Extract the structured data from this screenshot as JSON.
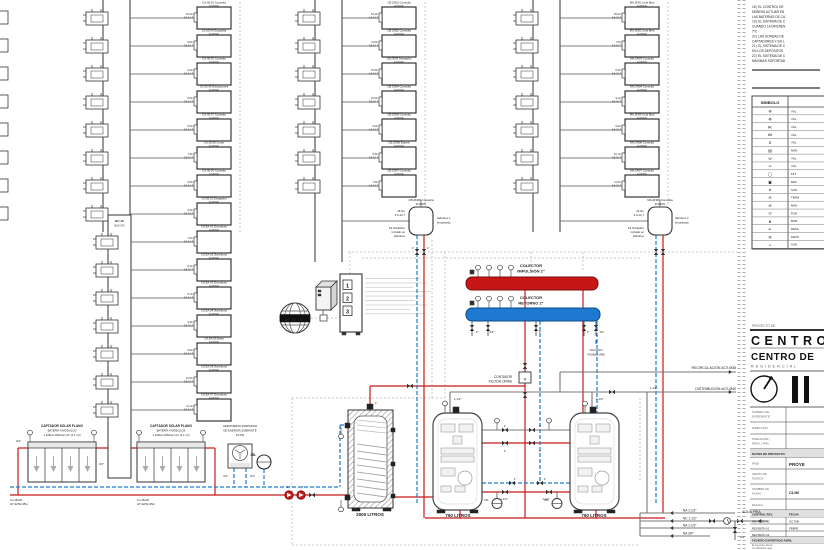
{
  "meta": {
    "red": "#c81a1a",
    "blue": "#1e7ad0",
    "gray": "#8a8a8a",
    "wire": "#c9c9c9",
    "dark": "#333333"
  },
  "notes": {
    "lines": [
      "18 | EL CONTROL DE",
      "DEBERÁ ACTUAR EN",
      "LAS BATERÍAS DE CA",
      "19 | EL SISTEMA DE C",
      "CUANDO LA DIFEREN",
      "7ºC",
      "20 | LAS SONDAS DE",
      "CAPTADORES Y EN L",
      "21 | EL SISTEMA DE C",
      "EN LOS DEPÓSITOS",
      "22 | EL SISTEMA DE C",
      "MÁXIMAS SOPORTAD"
    ]
  },
  "legend": {
    "title": "SÍMBOLO",
    "rows": [
      {
        "sym": "⊕",
        "label": "VÁL"
      },
      {
        "sym": "⊗",
        "label": "VÁL"
      },
      {
        "sym": "⋉",
        "label": "VÁL"
      },
      {
        "sym": "⋈",
        "label": "VÁL"
      },
      {
        "sym": "Ƨ",
        "label": "VÁL"
      },
      {
        "sym": "▤",
        "label": "MAN"
      },
      {
        "sym": "Ψ",
        "label": "VÁL"
      },
      {
        "sym": "∞",
        "label": "VÁL"
      },
      {
        "sym": "◯",
        "label": "FILT"
      },
      {
        "sym": "▣",
        "label": "DES"
      },
      {
        "sym": "♦",
        "label": "SON"
      },
      {
        "sym": "⊖",
        "label": "TERM"
      },
      {
        "sym": "⊘",
        "label": "MAN"
      },
      {
        "sym": "⊙",
        "label": "PUR"
      },
      {
        "sym": "▲",
        "label": "BOM"
      },
      {
        "sym": "↵",
        "label": "DESA"
      },
      {
        "sym": "⊜",
        "label": "DEPÓ"
      },
      {
        "sym": "⊥",
        "label": "SON"
      }
    ]
  },
  "titleblock": {
    "proyecto_de": "PROYECTO DE:",
    "title1": "CENTRO",
    "title2": "CENTRO DE",
    "title3": "RESIDENCIAL",
    "f1a": "NÚMERO DE",
    "f1b": "EXPEDIENTE",
    "f2": "DIRECCIÓN",
    "f3a": "POBLACIÓN |",
    "f3b": "PROV. | PAÍS",
    "datos": "DATOS DE PROYECTO",
    "fase": "FASE",
    "fase_v": "PROYE",
    "grupo_a": "GRUPO DE",
    "grupo_b": "PLANOS",
    "nombre_a": "NOMBRE DE",
    "nombre_b": "PLANO",
    "nombre_v": "CLIM",
    "escala": "ESCALA",
    "control": "CONTROL REV.",
    "fecha": "FECHA",
    "rev0": "REVISIÓN 00",
    "rev0_v": "OCTUB",
    "rev1": "REVISIÓN 01",
    "rev1_v": "FEBRE",
    "rev2": "REVISIÓN 02",
    "fichero": "FICHERO EXPORTADO ABRIL",
    "disc": [
      "El presente docum",
      "su utilización requ",
      "autorización expre"
    ]
  },
  "collectors": {
    "supply1": "COLECTOR",
    "supply2": "IMPULSIÓN 2\"",
    "return1": "COLECTOR",
    "return2": "RETORNO 2\""
  },
  "center": {
    "www": "WWW",
    "panel": [
      "1",
      "2",
      "3"
    ],
    "contador1": "CONTADOR",
    "contador2": "KILOCALORÍAS",
    "meter": "M",
    "vaciado1": "VACIADO",
    "vaciado2": "VISIBLE Ø40"
  },
  "tanks": {
    "t1": "2000 LITROS",
    "t2": "750 LITROS",
    "t3": "750 LITROS",
    "v1": "12L",
    "v2": "12L"
  },
  "solar": {
    "title": "CAPTADOR SOLAR PLANO",
    "sub": "BATERÍA 4 MÓDULOS",
    "dims": "1.108x2.118x112 mm (2,1 m²)",
    "pipe1": "Cu 28x25",
    "pipe2": "HT-32/52-35H",
    "aero1": "AEROTERMO DISIPADOR",
    "aero2": "DE ENERGÍA SOBRANTE",
    "aero3": "16 KW",
    "vessel": "35L"
  },
  "acs": {
    "recirc": "RECIRCULACIÓN ACS Ø38",
    "distrib": "DISTRIBUCIÓN ACS Ø40"
  },
  "bottom": {
    "na1": "NA 1-1/2\"",
    "nc": "NC 1-1/2\"",
    "na2": "NA 1-1/2\"",
    "na3": "NA 3/4\"",
    "agua": "AGUA FRÍA"
  },
  "sizes": {
    "s34": "3/4\"",
    "s1": "1\"",
    "s112": "1-1/2\"",
    "s2": "2\"",
    "s12": "1/2\""
  },
  "units": {
    "model": "FUZION",
    "g1": {
      "rows": [
        {
          "name": "CA.05.03 Consulta",
          "len": "10,6m",
          "spec": "0,6-10,7"
        },
        {
          "name": "CA.05.04 Ecografía",
          "len": "9,8m",
          "spec": "0,6-10,7"
        },
        {
          "name": "CA.05.05 Consulta",
          "len": "9,2m",
          "spec": "0,6-10,7"
        },
        {
          "name": "CA.05.06 Extracciones",
          "len": "8,6m",
          "spec": "0,6-10,7"
        },
        {
          "name": "CA.05.07 Consulta",
          "len": "8,0m",
          "spec": "0,6-10,7"
        },
        {
          "name": "CA.05.08 Curas",
          "len": "7,4m",
          "spec": "0,6-10,7"
        },
        {
          "name": "CA.05.09 Consulta",
          "len": "6,8m",
          "spec": "0,6-10,7"
        },
        {
          "name": "CA.05.10 Despacho",
          "len": "6,2m",
          "spec": "0,6-10,7"
        }
      ]
    },
    "g2": {
      "rows": [
        {
          "name": "CB.ZN01 Consulta",
          "len": "12,4m",
          "spec": "0,6-10,7"
        },
        {
          "name": "CB.ZN02 Consulta",
          "len": "11,6m",
          "spec": "0,6-10,7"
        },
        {
          "name": "CB.ZN03 Despacho",
          "len": "10,8m",
          "spec": "0,6-10,7"
        },
        {
          "name": "CB.ZN04 Consulta",
          "len": "10,0m",
          "spec": "0,6-10,7"
        },
        {
          "name": "CB.ZN05 Consulta",
          "len": "9,2m",
          "spec": "0,6-10,7"
        },
        {
          "name": "CB.ZN06 Espera",
          "len": "8,4m",
          "spec": "0,6-10,7"
        },
        {
          "name": "CB.ZN07 Consulta",
          "len": "7,6m",
          "spec": "0,6-10,7"
        }
      ],
      "special": {
        "name": "CB.ZN08 Consulta",
        "len": "45,0m",
        "spec": "4,0-12,7",
        "hb1": "Hidrobox 1",
        "hb2": "encastrado",
        "kit1": "Kit hidráulico",
        "kit2": "incluido en",
        "kit3": "Hidrobox"
      }
    },
    "g3": {
      "rows": [
        {
          "name": "MA.ZN01 Unid Med",
          "len": "29,0m",
          "spec": "0,6-10,7"
        },
        {
          "name": "MA.ZN02 Unid Med",
          "len": "7,5m",
          "spec": "0,6-10,7"
        },
        {
          "name": "MA.ZN03 Consulta",
          "len": "8,3m",
          "spec": "0,6-10,7"
        },
        {
          "name": "MA.ZN04 Consulta",
          "len": "9,1m",
          "spec": "0,6-10,7"
        },
        {
          "name": "MA.ZN05 Unid Med",
          "len": "9,9m",
          "spec": "0,6-10,7"
        },
        {
          "name": "MA.ZN06 Consulta",
          "len": "10,7m",
          "spec": "0,6-10,7"
        },
        {
          "name": "MA.ZN07 Consulta",
          "len": "11,5m",
          "spec": "0,6-10,7"
        }
      ],
      "special": {
        "name": "MA.ZN08 Consulta",
        "len": "24,0m",
        "spec": "4,0-12,7",
        "hb1": "Hidrobox 2",
        "hb2": "encastrado",
        "kit1": "Kit hidráulico",
        "kit2": "incluido en",
        "kit3": "Hidrobox"
      }
    },
    "bc": {
      "header1": "BC 16",
      "header2": "BUS 070",
      "rows": [
        {
          "name": "CA.EA.01 Dormitorio",
          "len": "7,5m",
          "spec": "0,6-10,7"
        },
        {
          "name": "CA.EA.02 Dormitorio",
          "len": "8,1m",
          "spec": "0,6-10,7"
        },
        {
          "name": "CA.EA.03 Dormitorio",
          "len": "8,7m",
          "spec": "0,6-10,7"
        },
        {
          "name": "CA.EA.04 Dormitorio",
          "len": "9,3m",
          "spec": "0,6-10,7"
        },
        {
          "name": "CA.EA.05 Estar",
          "len": "9,9m",
          "spec": "0,6-10,7"
        },
        {
          "name": "CA.EA.06 Dormitorio",
          "len": "10,5m",
          "spec": "0,6-10,7"
        },
        {
          "name": "CA.EA.07 Dormitorio",
          "len": "11,1m",
          "spec": "0,6-10,7"
        }
      ]
    }
  }
}
